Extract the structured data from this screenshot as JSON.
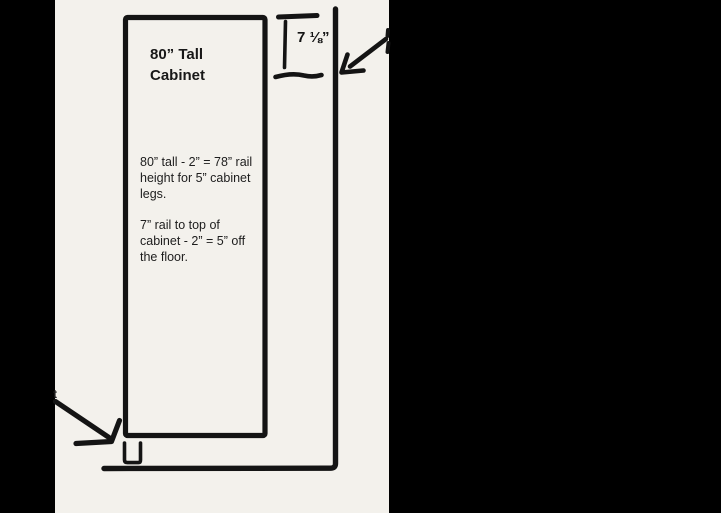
{
  "drawing": {
    "canvas_background": "#f3f1ec",
    "ink_color": "#141414",
    "letterbox_color": "#000000"
  },
  "cabinet": {
    "title_lines": [
      "80” Tall",
      "Cabinet"
    ],
    "notes": [
      {
        "text": "80” tall - 2” = 78” rail height for 5” cabinet legs.",
        "lines": [
          "80” tall - 2” = 78” rail",
          "height for 5” cabinet",
          "legs."
        ]
      },
      {
        "text": "7” rail to top of cabinet - 2” = 5” off the floor.",
        "lines": [
          "7” rail to top of",
          "cabinet - 2” = 5” off",
          "the floor."
        ]
      }
    ]
  },
  "measurements": {
    "top_gap_label": "7 ⅛”"
  },
  "cutoff": {
    "left_edge_text": "t"
  }
}
